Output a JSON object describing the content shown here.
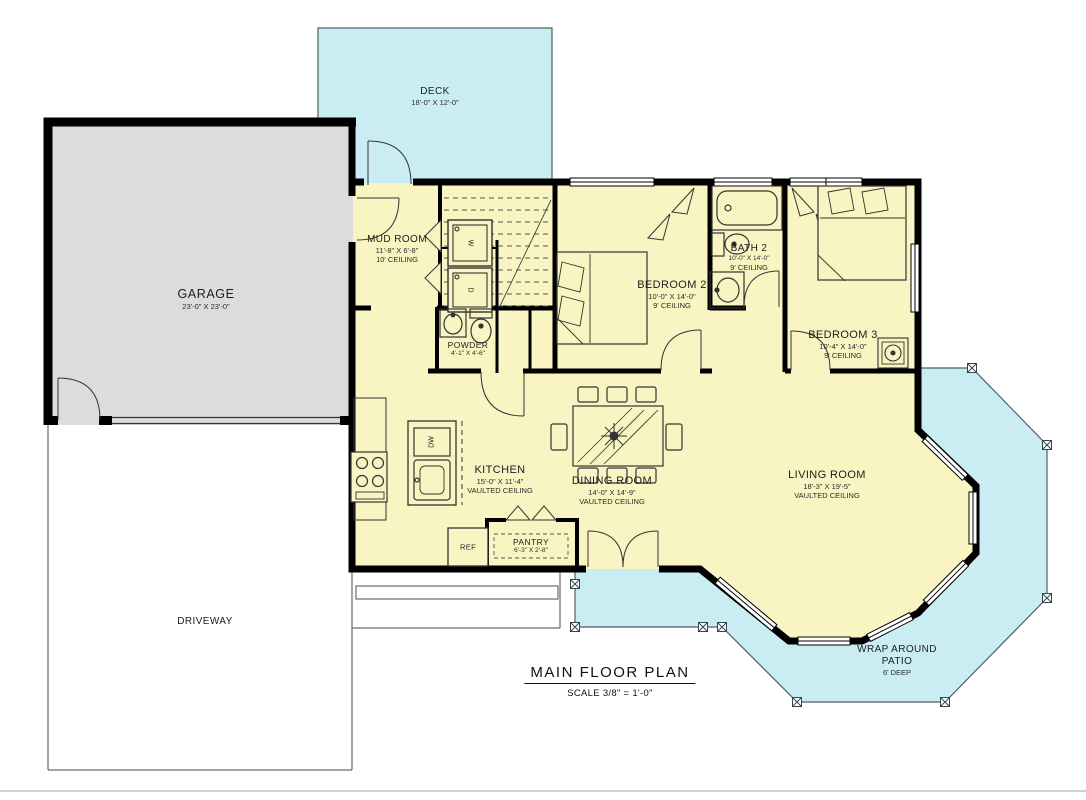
{
  "title": {
    "text": "MAIN FLOOR PLAN",
    "scale": "SCALE 3/8\" = 1'-0\""
  },
  "rooms": {
    "deck": {
      "name": "DECK",
      "dims": "18'-0\" X 12'-0\""
    },
    "garage": {
      "name": "GARAGE",
      "dims": "23'-0\" X 23'-0\""
    },
    "mud_room": {
      "name": "MUD ROOM",
      "dims": "11'-8\" X 6'-8\"",
      "ceiling": "10' CEILING"
    },
    "powder": {
      "name": "POWDER",
      "dims": "4'-1\" X 4'-6\""
    },
    "bedroom2": {
      "name": "BEDROOM 2",
      "dims": "10'-0\" X 14'-0\"",
      "ceiling": "9' CEILING"
    },
    "bath2": {
      "name": "BATH 2",
      "dims": "10'-0\" X 14'-0\"",
      "ceiling": "9' CEILING"
    },
    "bedroom3": {
      "name": "BEDROOM 3",
      "dims": "10'-4\" X 14'-0\"",
      "ceiling": "9' CEILING"
    },
    "kitchen": {
      "name": "KITCHEN",
      "dims": "15'-0\" X 11'-4\"",
      "ceiling": "VAULTED CEILING"
    },
    "dining": {
      "name": "DINING ROOM",
      "dims": "14'-0\" X 14'-9\"",
      "ceiling": "VAULTED CEILING"
    },
    "living": {
      "name": "LIVING ROOM",
      "dims": "18'-3\" X 19'-5\"",
      "ceiling": "VAULTED CEILING"
    },
    "pantry": {
      "name": "PANTRY",
      "dims": "6'-3\" X 2'-8\""
    },
    "patio": {
      "name1": "WRAP AROUND",
      "name2": "PATIO",
      "depth": "6' DEEP"
    },
    "driveway": {
      "name": "DRIVEWAY"
    }
  },
  "appliances": {
    "ref": "REF",
    "dishwasher": "DW",
    "washer": "W",
    "dryer": "D"
  },
  "colors": {
    "patio": "#c9edf3",
    "interior": "#f8f5c3",
    "garage": "#dcdcdc",
    "wall": "#000000"
  }
}
